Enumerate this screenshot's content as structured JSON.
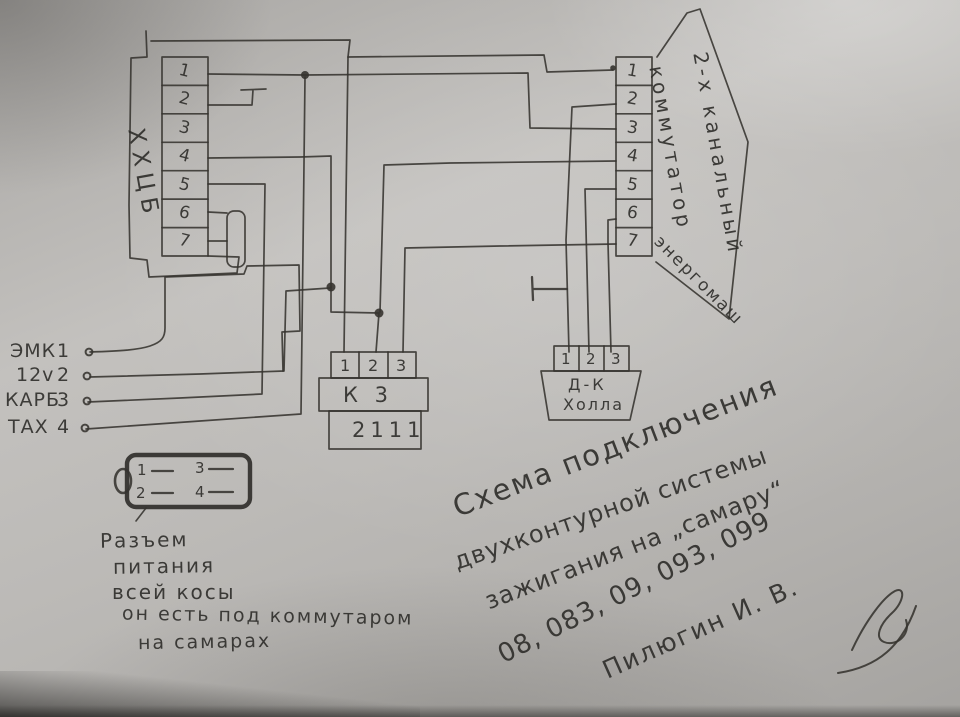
{
  "left_connector": {
    "label": "ХХЦБ",
    "pins": [
      "1",
      "2",
      "3",
      "4",
      "5",
      "6",
      "7"
    ]
  },
  "commutator": {
    "pins": [
      "1",
      "2",
      "3",
      "4",
      "5",
      "6",
      "7"
    ],
    "label_line1": "2-х канальный",
    "label_line2": "коммутатор",
    "brand": "энергомаш"
  },
  "k3_block": {
    "pins": [
      "1",
      "2",
      "3"
    ],
    "name": "К 3",
    "model": "2111"
  },
  "hall_sensor": {
    "pins": [
      "1",
      "2",
      "3"
    ],
    "name_line1": "Д-К",
    "name_line2": "Холла"
  },
  "terminals": [
    {
      "label": "ЭМК",
      "num": "1"
    },
    {
      "label": "12v",
      "num": "2"
    },
    {
      "label": "КАРБ",
      "num": "3"
    },
    {
      "label": "ТАХ",
      "num": "4"
    }
  ],
  "power_connector": {
    "pins": [
      "1",
      "2",
      "3",
      "4"
    ]
  },
  "note_lines": [
    "Разъем",
    "питания",
    "всей косы",
    "он есть под коммутаром",
    "на самарах"
  ],
  "title_lines": [
    "Схема подключения",
    "двухконтурной системы",
    "зажигания на „самару“",
    "08, 083, 09, 093, 099"
  ],
  "signature": "Пилюгин И. В.",
  "colors": {
    "paper": "#b5b3b0",
    "ink": "#35332f"
  }
}
